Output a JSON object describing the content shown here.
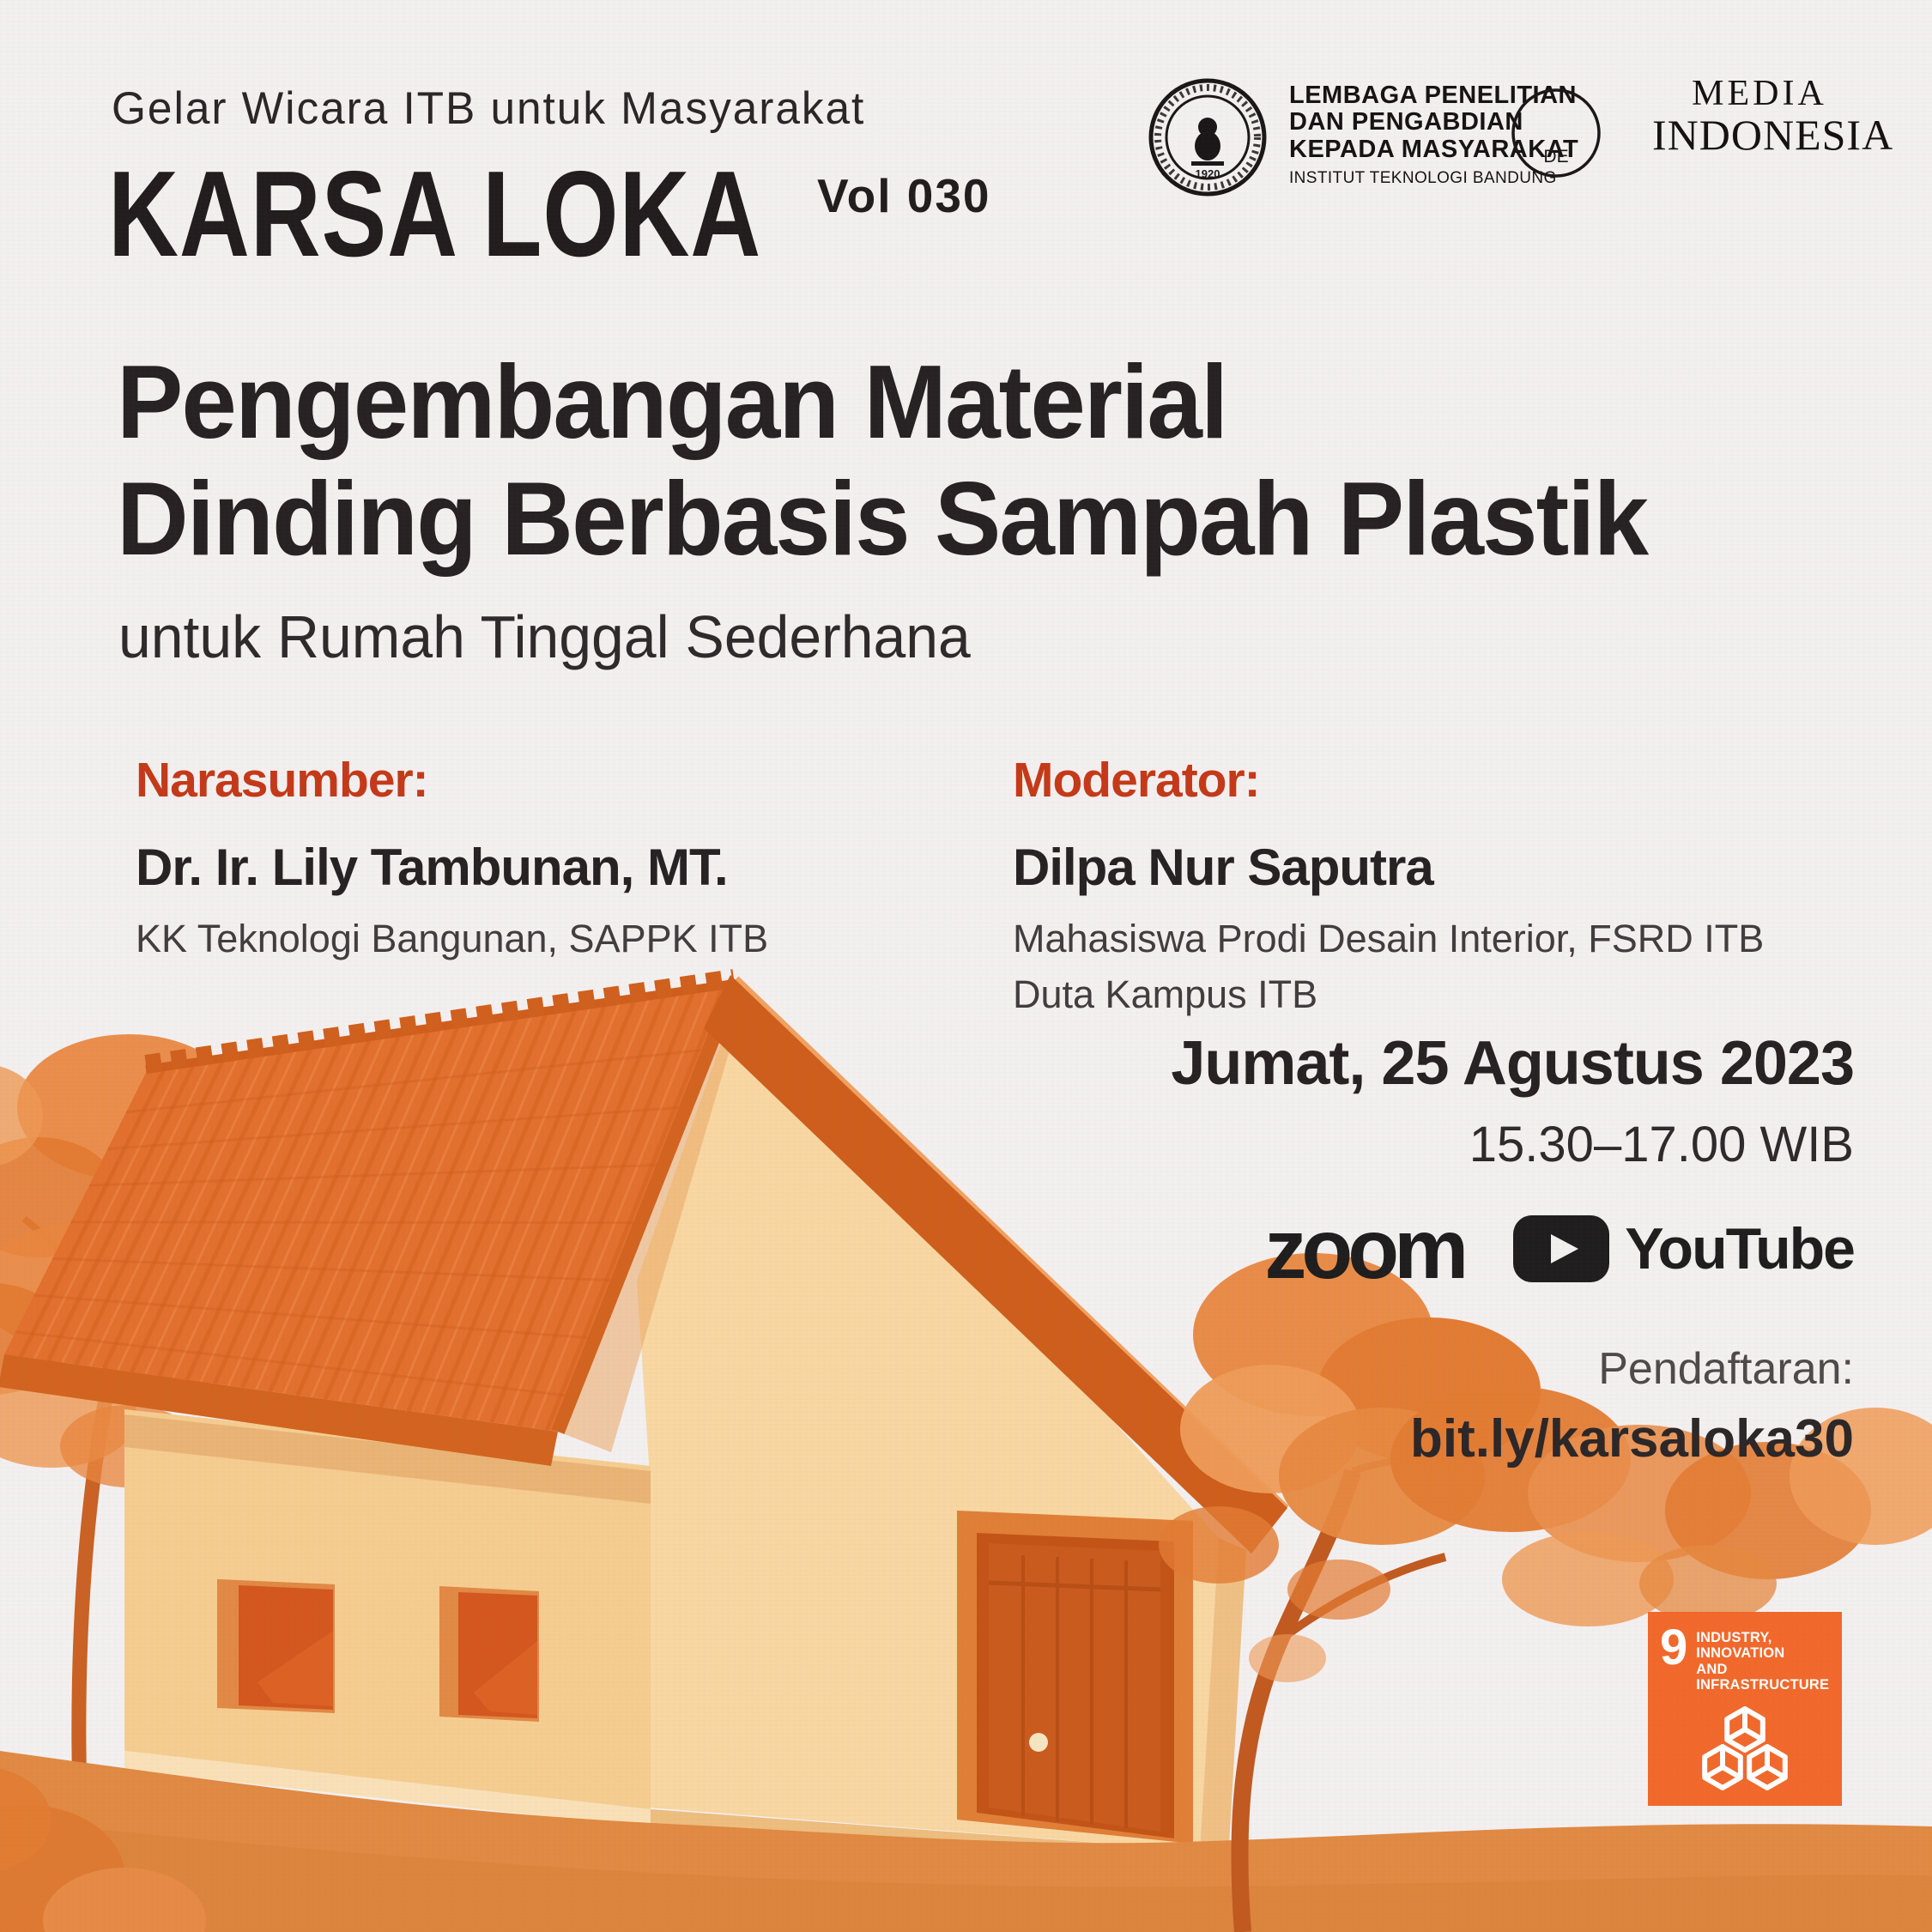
{
  "colors": {
    "accent_red": "#C43A18",
    "roof_orange": "#E2702E",
    "wall_cream": "#F5CD90",
    "badge_orange": "#F1692B",
    "ink": "#262223"
  },
  "header": {
    "event_series": "Gelar Wicara ITB untuk Masyarakat",
    "logo_title": "KARSA LOKA",
    "volume": "Vol 030"
  },
  "partners": {
    "itb_seal_year": "1920",
    "lppm_line1": "LEMBAGA PENELITIAN",
    "lppm_line2": "DAN PENGABDIAN",
    "lppm_line3": "KEPADA MASYARAKAT",
    "lppm_line4": "INSTITUT TEKNOLOGI BANDUNG",
    "de_monogram": "DE",
    "media_line1": "MEDIA",
    "media_line2": "INDONESIA"
  },
  "title": {
    "line1": "Pengembangan Material",
    "line2": "Dinding Berbasis Sampah Plastik",
    "subtitle": "untuk Rumah Tinggal Sederhana"
  },
  "speaker": {
    "heading": "Narasumber:",
    "name": "Dr. Ir. Lily Tambunan, MT.",
    "affiliation": "KK Teknologi Bangunan, SAPPK ITB"
  },
  "moderator": {
    "heading": "Moderator:",
    "name": "Dilpa Nur Saputra",
    "affiliation1": "Mahasiswa Prodi Desain Interior, FSRD ITB",
    "affiliation2": "Duta Kampus ITB"
  },
  "schedule": {
    "date": "Jumat, 25 Agustus 2023",
    "time": "15.30–17.00 WIB"
  },
  "platforms": {
    "zoom_label": "zoom",
    "youtube_label": "YouTube"
  },
  "registration": {
    "label": "Pendaftaran:",
    "link": "bit.ly/karsaloka30"
  },
  "sdg": {
    "number": "9",
    "label_line1": "INDUSTRY, INNOVATION",
    "label_line2": "AND INFRASTRUCTURE"
  }
}
